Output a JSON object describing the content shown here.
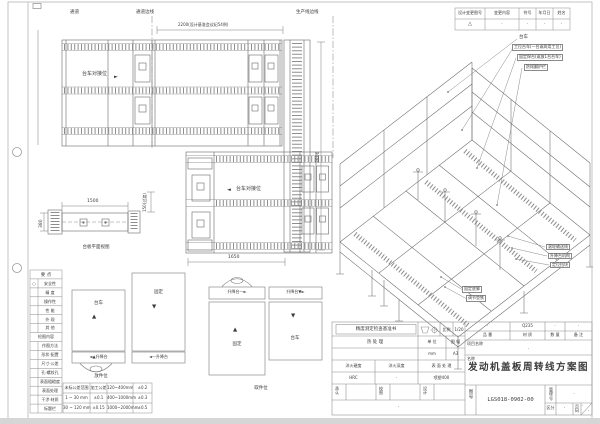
{
  "top_labels": {
    "aisle": "通道",
    "aisle_edge": "通道边线",
    "production_edge": "生产线边线",
    "dim_2200": "2200(设计基准会议纪54例)"
  },
  "plan_top": {
    "dock_label": "台车对接位",
    "dock_arrow": "►",
    "dim_3800": "3800"
  },
  "plan_mid": {
    "dock_arrow": "◄",
    "dock_label": "台车对接位",
    "dim_1650": "1650",
    "dim_150": "150(过渡)"
  },
  "side_view": {
    "dim_1500": "1500",
    "dim_380": "380",
    "caption": "台板平面视图"
  },
  "revision": {
    "headers": [
      "设计变更图号",
      "变更内容",
      "符号",
      "年月日",
      "姓名"
    ],
    "row": [
      "△",
      "·",
      "·",
      "·",
      "·"
    ]
  },
  "iso": {
    "callouts_top": [
      "台车",
      "工位台车(一台或两用工位)",
      "固定焊台(或放1台台车)",
      "防倾翻护栏"
    ],
    "callouts_right": [
      "滚轮输送线",
      "升降台机构",
      "定位挡块"
    ],
    "callouts_bottom": [
      "固定底脚",
      "调节垫铁"
    ]
  },
  "legend": {
    "header1": "要 点",
    "circle": "○",
    "items1": [
      "安全性",
      "精 度",
      "操作性",
      "性 能",
      "外 观",
      "其 他"
    ],
    "header2": "检图内容",
    "items2": [
      "作图方法",
      "形状·配置",
      "尺寸·公差",
      "孔·螺纹孔",
      "表面粗糙度",
      "表面处理",
      "干涉·材质",
      "标题栏"
    ]
  },
  "tolerance": {
    "rows": [
      [
        "未标公差范围",
        "加工公差",
        "120~400mm",
        "±0.2"
      ],
      [
        "1 ~ 30 mm",
        "±0.1",
        "400~1000mm",
        "±0.3"
      ],
      [
        "30 ~ 120 mm",
        "±0.15",
        "1000~2000mm",
        "±0.5"
      ]
    ]
  },
  "schematic": {
    "cart": "台车",
    "fixed": "固定",
    "lift_a": "◄▲升降台",
    "lift_b": "◄—升降台",
    "lift_c": "升降台—►",
    "lift_d": "升降台▼►",
    "up": "▲",
    "down": "▼",
    "place_caption": "放件位",
    "pick_caption": "取件位"
  },
  "title_block": {
    "check_title": "精度测定检查基准书",
    "scale_label": "比例",
    "scale_value": "1/20",
    "heat_label": "热 处 理",
    "unit_label": "单 位",
    "unit_value": "mm",
    "sheet_label": "图 幅",
    "sheet_value": "A3",
    "hardness_label": "淬火硬度",
    "hardness_value": "HRC",
    "depth_label": "淬火深度",
    "depth_value": "·",
    "surface_label": "表 面 处 理",
    "surface_value": "喷塑400",
    "approve_label": "承认",
    "check_label": "校图",
    "design_label": "设计",
    "note_value": "·",
    "part_header": "品 番",
    "part_value": "·",
    "material_header": "材 质",
    "material_value": "Q235",
    "qty_header": "数 量",
    "qty_value": "·",
    "remark_header": "备 注",
    "remark_value": "·",
    "project_label": "项目名称",
    "project_value": "·",
    "name_label": "名称",
    "drawing_title": "发动机盖板周转线方案图",
    "drawno_label": "图号",
    "drawno_value": "LGS018-0902-00",
    "mgmt_label": "管理号",
    "mgmt_value": "·",
    "class_label": "区分",
    "class_value": "·",
    "page_label": "页码",
    "page_top": "·",
    "page_bottom": "·"
  }
}
